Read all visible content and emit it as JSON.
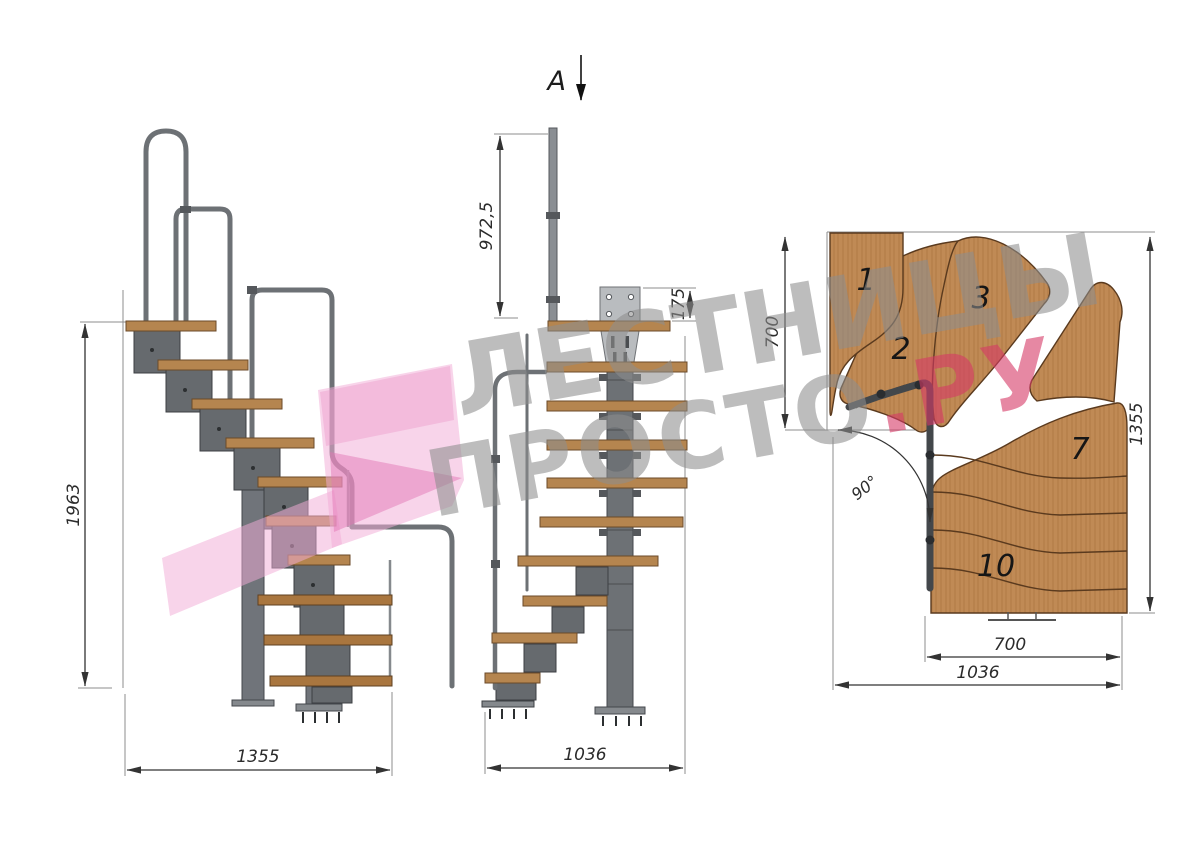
{
  "drawing": {
    "section_marker": "A",
    "side_view": {
      "height": "1963",
      "length": "1355"
    },
    "front_view": {
      "post_height": "972,5",
      "plate_height": "175",
      "width": "1036"
    },
    "plan_view": {
      "entry_width": "700",
      "total_depth": "1355",
      "exit_width": "700",
      "total_width": "1036",
      "turn_angle": "90°",
      "step_labels": [
        "1",
        "2",
        "3",
        "7",
        "10"
      ]
    }
  },
  "watermark": {
    "line1": "ЛЕСТНИЦЫ",
    "line2": "ПРОСТО",
    "line2_accent": ".РУ",
    "accent_color": "#d53965",
    "gray_color": "#8d8d8d",
    "logo_pink": "#f2add7"
  },
  "palette": {
    "wood": "#b5854f",
    "wood_dark": "#a9763f",
    "metal": "#70747a",
    "metal_dark": "#44474c",
    "dimension_lines": "#333333"
  }
}
